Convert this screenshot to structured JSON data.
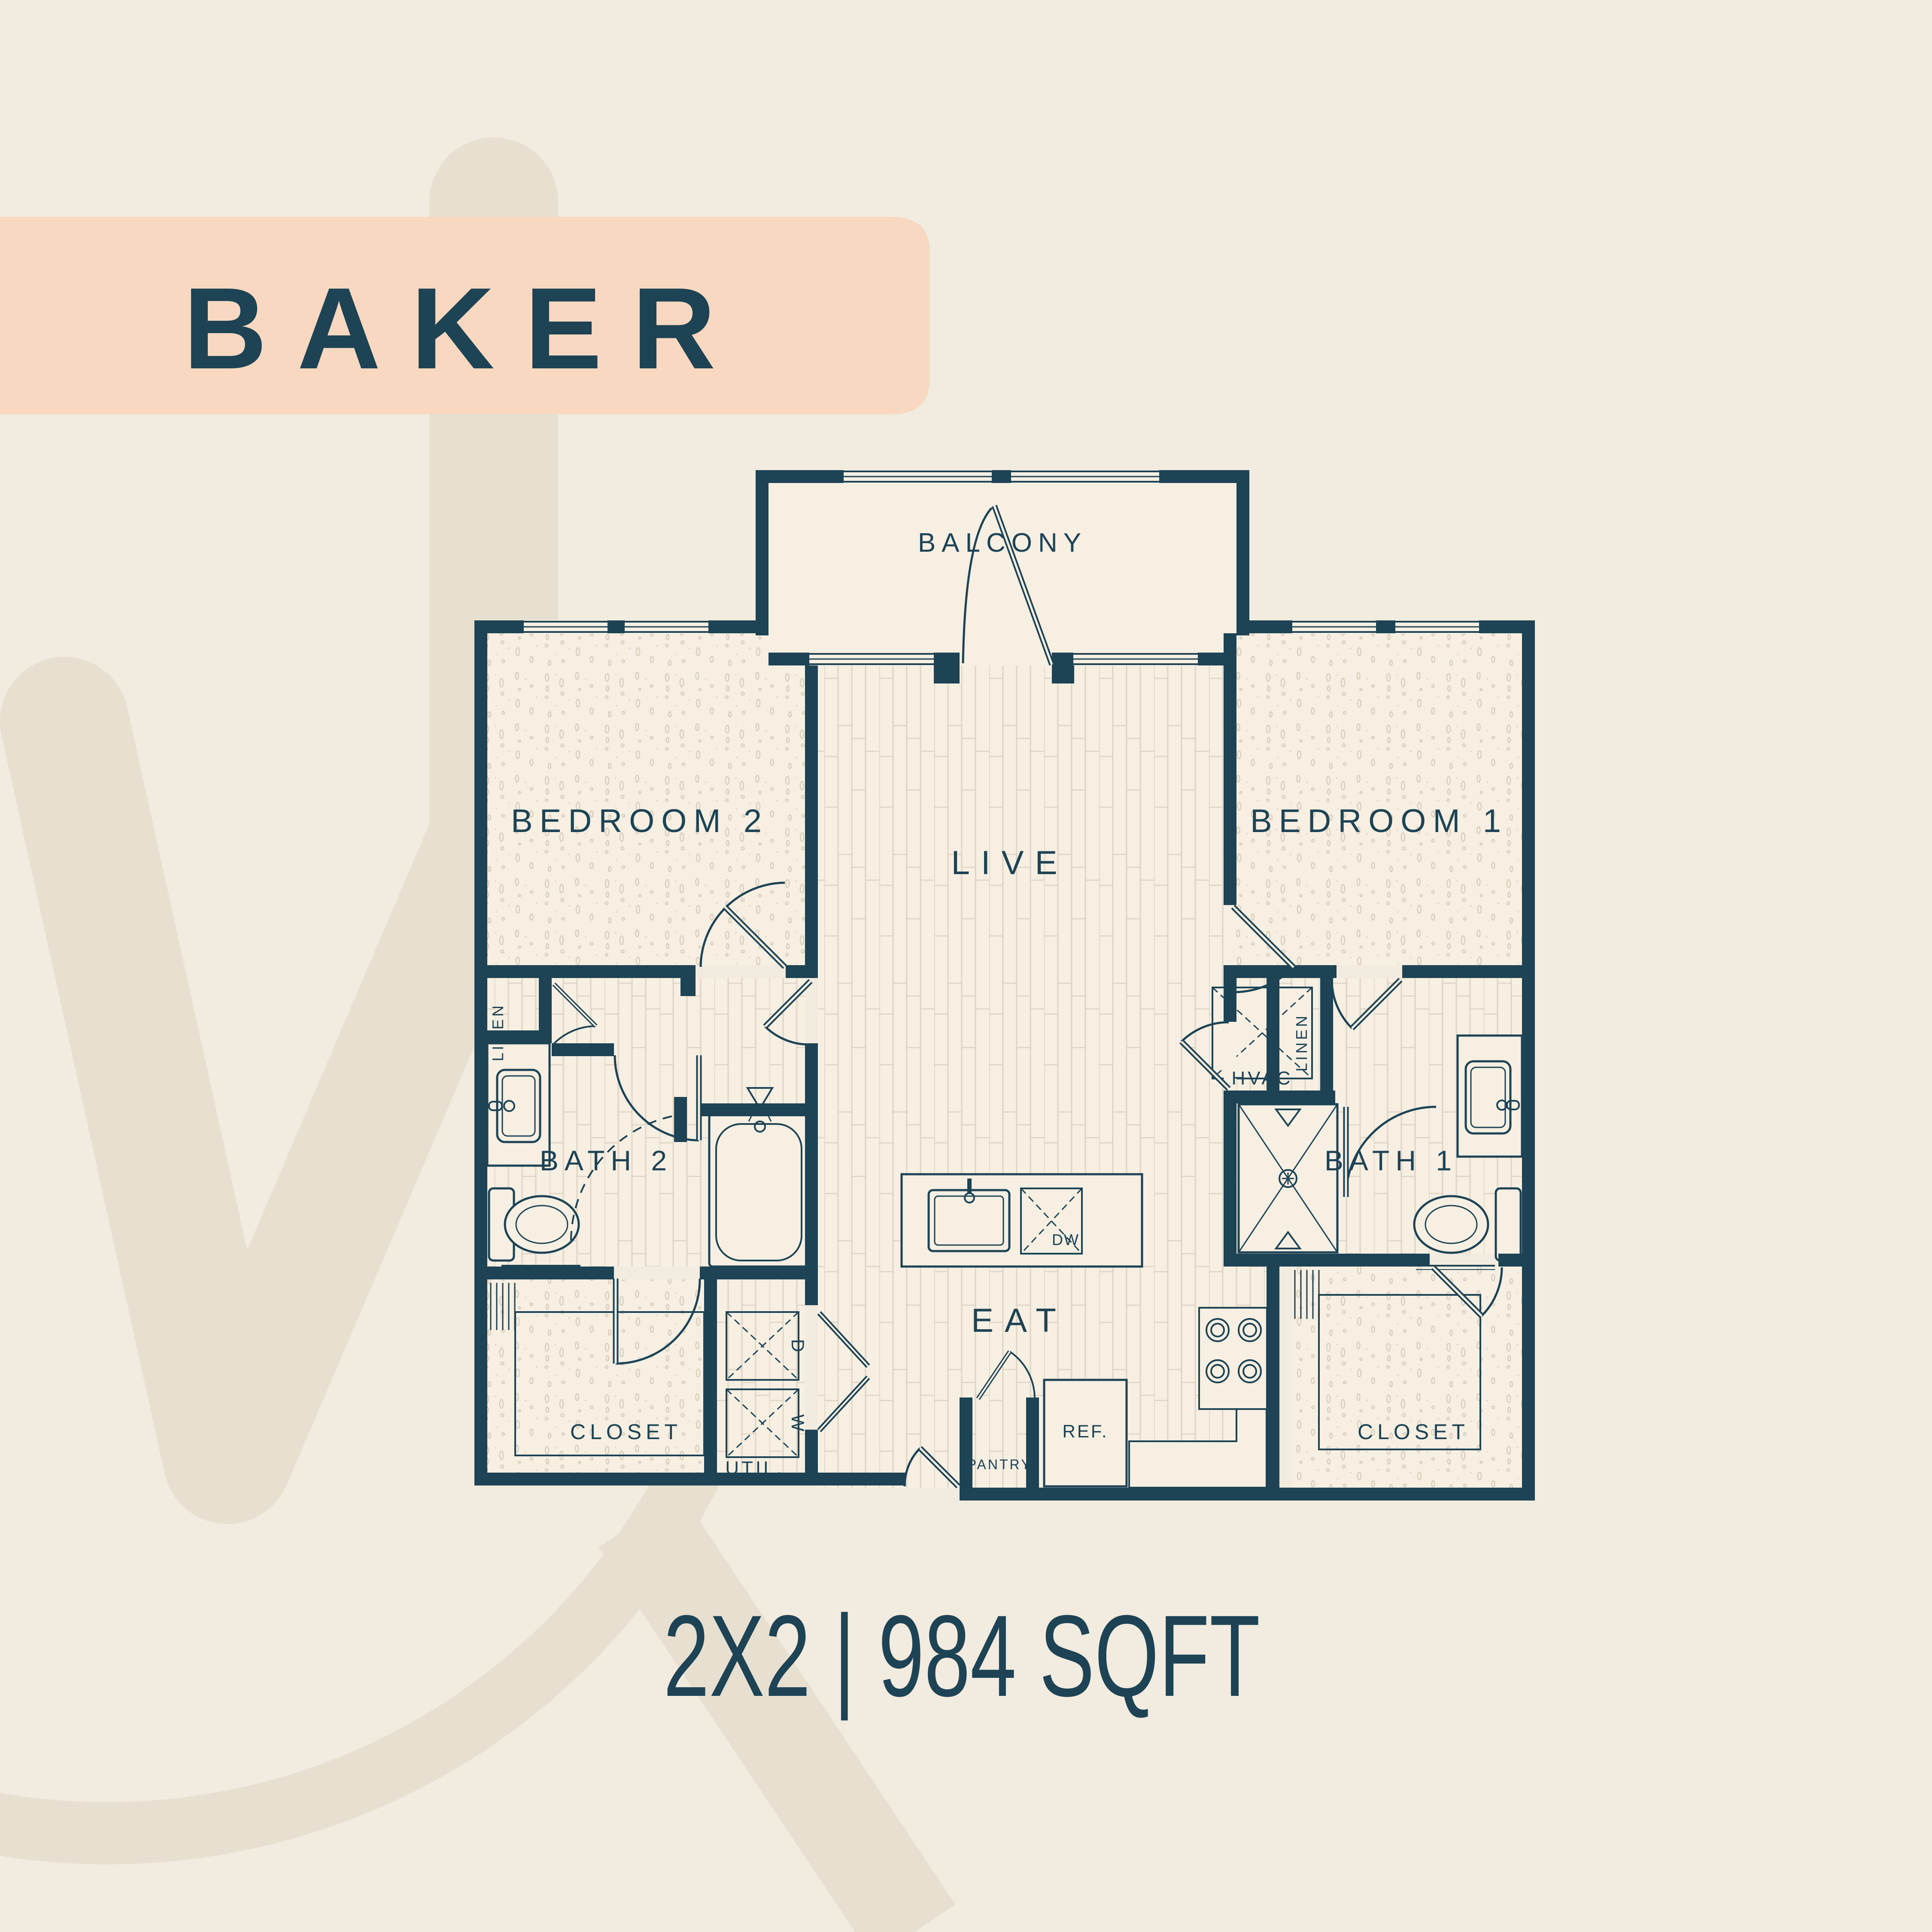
{
  "title": "BAKER",
  "caption": "2X2 | 984 SQFT",
  "colors": {
    "background": "#f2ebdf",
    "watermark": "#e7e0d1",
    "banner": "#f8d8c0",
    "ink": "#1d4355",
    "floor": "#f6efe2",
    "floor_lines": "#d8cdbb"
  },
  "rooms": {
    "balcony": "BALCONY",
    "live": "LIVE",
    "eat": "EAT",
    "bedroom1": "BEDROOM 1",
    "bedroom2": "BEDROOM 2",
    "bath1": "BATH 1",
    "bath2": "BATH 2",
    "closet1": "CLOSET",
    "closet2": "CLOSET",
    "util": "UTIL.",
    "pantry": "PANTRY",
    "linen1": "LINEN",
    "linen2": "LINEN",
    "hvac": "HVAC"
  },
  "fixtures": {
    "refrigerator": "REF.",
    "dishwasher": "DW",
    "dryer": "D",
    "washer": "W"
  }
}
